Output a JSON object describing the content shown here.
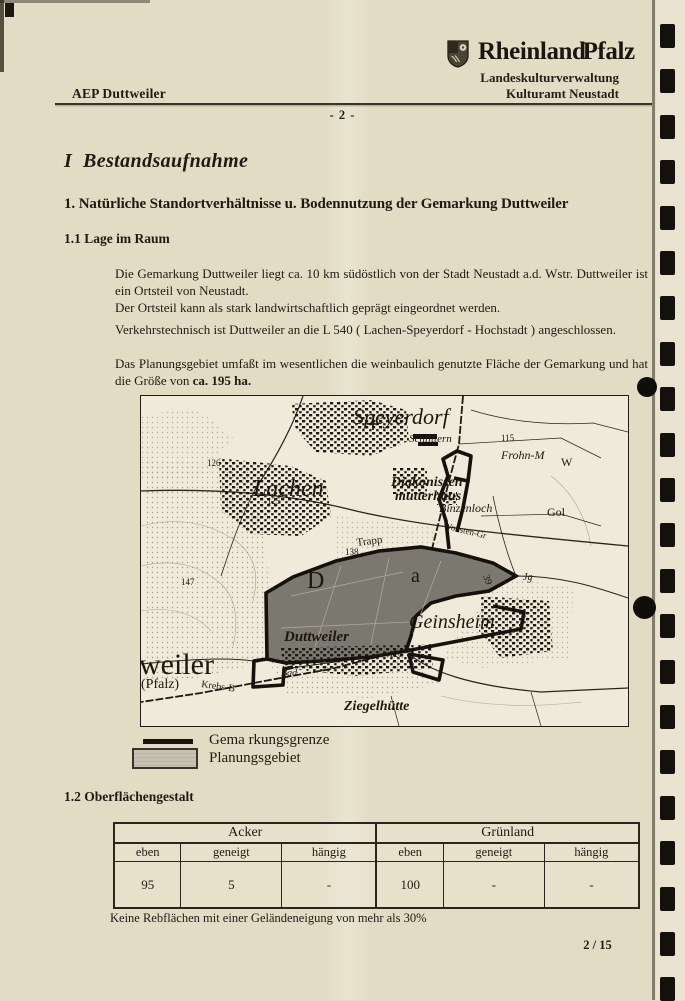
{
  "header": {
    "doc_ref": "AEP Duttweiler",
    "brand_part1": "Rheinland",
    "brand_part2": "Pfalz",
    "org_line1": "Landeskulturverwaltung",
    "org_line2": "Kulturamt Neustadt",
    "page_marker": "- 2 -"
  },
  "content": {
    "heading1": "I  Bestandsaufnahme",
    "heading2": "1. Natürliche Standortverhältnisse u. Bodennutzung der Gemarkung Duttweiler",
    "heading3": "1.1 Lage im Raum",
    "para1_line1": "Die Gemarkung Duttweiler liegt ca. 10 km südöstlich von der Stadt Neustadt a.d. Wstr. Duttweiler ist ein Ortsteil von Neustadt.",
    "para1_line2": "Der Ortsteil kann als stark landwirtschaftlich geprägt eingeordnet werden.",
    "para2": "Verkehrstechnisch ist Duttweiler an die L 540  ( Lachen-Speyerdorf - Hochstadt ) angeschlossen.",
    "para3_text": "Das Planungsgebiet umfaßt im wesentlichen die weinbaulich genutzte Fläche der Gemarkung und hat die Größe von",
    "para3_bold": "ca. 195 ha."
  },
  "map": {
    "labels": [
      "Speyerdorf",
      "Lachen",
      "126",
      "125",
      "Schlittern",
      "115",
      "Frohn-M",
      "W",
      "Diakonissen",
      "mutterhaus",
      "Binzenloch",
      "Wonsten-Gr",
      "Gol",
      "Trapp",
      "138",
      "D",
      "a",
      "39",
      "Jg",
      "Geinsheim",
      "Duttweiler",
      "weiler",
      "(Pfalz)",
      "Krebs-B",
      "Bad",
      "120",
      "147",
      "Ziegelhütte"
    ]
  },
  "legend": {
    "boundary_label": "Gema rkungsgrenze",
    "planning_label": "Planungsgebiet"
  },
  "surface": {
    "heading": "1.2 Oberflächengestalt",
    "note": "Keine Rebflächen mit einer Geländeneigung von mehr als 30%"
  },
  "table": {
    "groups": [
      "Acker",
      "Grünland"
    ],
    "columns": [
      "eben",
      "geneigt",
      "hängig",
      "eben",
      "geneigt",
      "hängig"
    ],
    "values": [
      "95",
      "5",
      "-",
      "100",
      "-",
      "-"
    ]
  },
  "footer": {
    "page_number": "2 / 15"
  },
  "colors": {
    "paper": "#e2dcc4",
    "ink": "#1e1a14",
    "planning_gray": "#7b796f",
    "mark_black": "#14110d"
  }
}
